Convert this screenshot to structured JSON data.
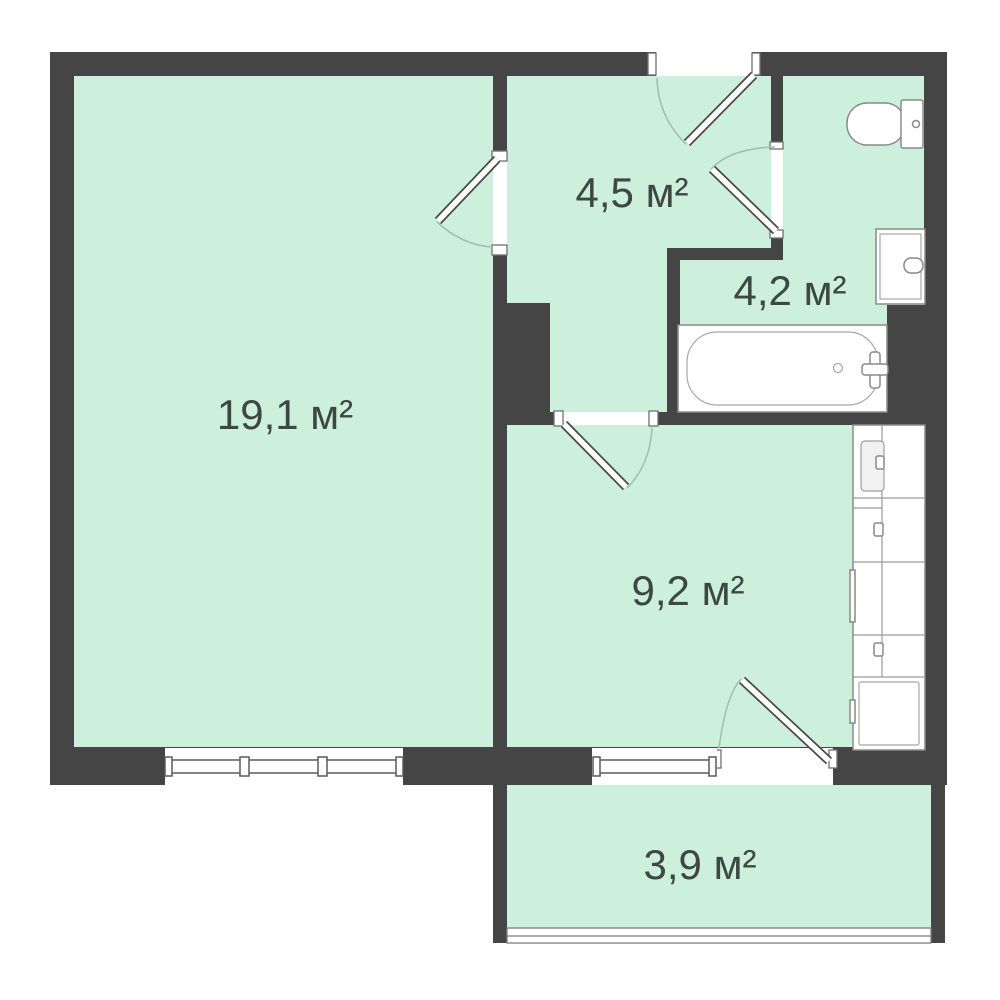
{
  "plan": {
    "type": "apartment-floor-plan",
    "rooms": [
      {
        "id": "living-room",
        "area_label": "19,1 м²"
      },
      {
        "id": "hallway",
        "area_label": "4,5 м²"
      },
      {
        "id": "bathroom",
        "area_label": "4,2 м²"
      },
      {
        "id": "kitchen",
        "area_label": "9,2 м²"
      },
      {
        "id": "balcony",
        "area_label": "3,9 м²"
      }
    ],
    "fixtures": [
      "toilet",
      "sink",
      "bathtub",
      "bath-faucet",
      "kitchen-counter",
      "stove",
      "fridge",
      "balcony-railing"
    ],
    "doors": [
      "entrance-door",
      "living-room-door",
      "bathroom-door",
      "kitchen-door",
      "balcony-door"
    ],
    "windows": [
      "living-room-window",
      "kitchen-window"
    ],
    "colors": {
      "wall": "#454545",
      "floor": "#cdf0dc",
      "label": "#3e4741",
      "door_arc": "#a3c0af",
      "fixture_outline": "#8a8a8a",
      "background": "#ffffff"
    }
  }
}
